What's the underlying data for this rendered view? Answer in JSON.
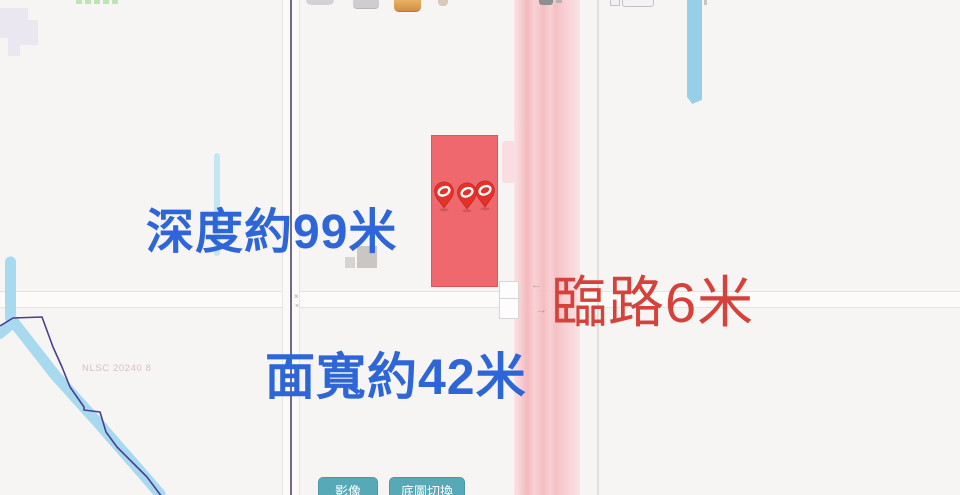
{
  "annotations": {
    "depth": {
      "text": "深度約99米",
      "color": "#2e66d8"
    },
    "frontage": {
      "text": "臨路6米",
      "color": "#d5423c"
    },
    "width": {
      "text": "面寬約42米",
      "color": "#2e66d8"
    }
  },
  "map": {
    "watermark": "NLSC 20240 8",
    "pin_count": 3,
    "pin_icon": "listing-pin",
    "intersection_marks": [
      "×",
      "×"
    ],
    "lane_arrows": [
      "←",
      "→"
    ],
    "colors": {
      "background": "#f6f5f3",
      "parcel_highlight": "#ee686e",
      "highway_pink": "#f4b9be",
      "water_blue": "#a7d9ef",
      "minor_road_blue": "#97cfe9",
      "cadastral_purple": "#565076",
      "boundary_indigo": "#4a3f90",
      "annotation_blue": "#2e66d8",
      "annotation_red": "#d5423c",
      "button_teal": "#58a9b8"
    }
  },
  "controls": {
    "imagery_button": "影像",
    "basemap_button": "底圖切換"
  }
}
